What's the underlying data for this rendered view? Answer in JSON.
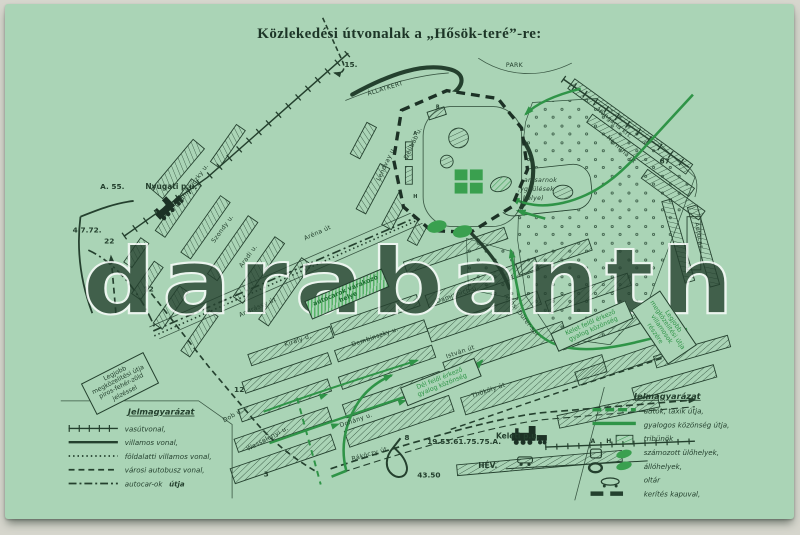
{
  "card": {
    "title": "Közlekedési útvonalak a „Hősök-teré”-re:",
    "watermark": "darabanth"
  },
  "colors": {
    "card_green": "#aad4b6",
    "ink_dark": "#24402e",
    "route_green": "#2f9447",
    "watermark_white": "#ffffff"
  },
  "stations": {
    "nyugati": "Nyugati p.u.",
    "keleti": "Keleti p.u.",
    "hev": "HÉV."
  },
  "areas": {
    "zoo": "ÁLLATKERT",
    "park": "PARK",
    "iparcsarnok_line1": "Iparcsarnok",
    "iparcsarnok_line2": "(nagygyülések",
    "iparcsarnok_line3": "helye)"
  },
  "streets": {
    "podmaniczky": "Podmaniczky u.",
    "szondy": "Szondy u.",
    "aradi": "Aradi u.",
    "andrassy": "Andrássy út",
    "kiraly": "Király u.",
    "dob": "Dob u.",
    "wesselenyi": "Wesselényi u.",
    "dohany": "Dohány u.",
    "rakoczy": "Rákóczy út",
    "dembinszky": "Dembinszky u.",
    "istvan": "István út",
    "thokoly": "Thököly út",
    "damjanich": "Damjanich u.",
    "arena": "Aréna út",
    "ajtosi": "Ajtósi Dürer-sor",
    "hermina": "Hermina út",
    "hungaria": "Hungária krt.",
    "lendvay": "Lendvay u.",
    "delibab": "Délibáb u.",
    "autocar": "Autocar"
  },
  "route_numbers": {
    "n15": "15.",
    "n22": "22",
    "n12a": "12",
    "n12b": "12",
    "n3": "3",
    "n8": "8",
    "n67": "67",
    "a55": "A. 55.",
    "n4772": "4.7.72.",
    "keleti_lines": "19.53.61.75.75.A.",
    "n4350": "43.50"
  },
  "square": {
    "tribune_a": "A",
    "tribune_b": "B",
    "tribune_h": "H"
  },
  "notes": {
    "best_route": "Legjobb megközelitési útja piros-fehér-zöld jelzéssel",
    "parking": "autócarok várakozó helye",
    "south_public": "Dél felől érkező gyalog közönség",
    "east_public": "Kelet felől érkező gyalog közönség",
    "tram_route": "Legjobb megközelitési útja villamosok részére"
  },
  "legend_left": {
    "title": "Jelmagyarázat",
    "items": [
      {
        "symbol": "railway-line",
        "label": "vasútvonal,"
      },
      {
        "symbol": "tram-line",
        "label": "villamos vonal,"
      },
      {
        "symbol": "underground-tram-line",
        "label": "földalatti villamos vonal,"
      },
      {
        "symbol": "city-bus-line",
        "label": "városi autobusz vonal,"
      },
      {
        "symbol": "autocar-route",
        "label": "autocar-ok",
        "label_suffix": "útja"
      }
    ]
  },
  "legend_right": {
    "title": "Jelmagyarázat",
    "tribune_letters": {
      "a": "A",
      "h": "H"
    },
    "items": [
      {
        "symbol": "car-taxi-route",
        "label": "autók, taxik útja,"
      },
      {
        "symbol": "pedestrian-route",
        "label": "gyalogos közönség útja,"
      },
      {
        "symbol": "tribunes",
        "label": "tribünök"
      },
      {
        "symbol": "numbered-seats",
        "label": "számozott ülőhelyek,"
      },
      {
        "symbol": "standing-places",
        "label": "állóhelyek,"
      },
      {
        "symbol": "altar",
        "label": "oltár"
      },
      {
        "symbol": "fence-with-gate",
        "label": "kerítés kapuval,"
      }
    ]
  }
}
